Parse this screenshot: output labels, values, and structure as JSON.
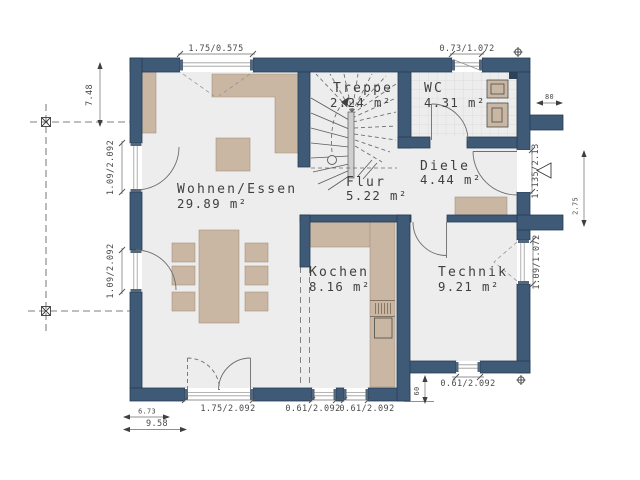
{
  "rooms": {
    "wohnen": {
      "name": "Wohnen/Essen",
      "area": "29.89 m²"
    },
    "treppe": {
      "name": "Treppe",
      "area": "2.24 m²"
    },
    "wc": {
      "name": "WC",
      "area": "4.31 m²"
    },
    "flur": {
      "name": "Flur",
      "area": "5.22 m²"
    },
    "diele": {
      "name": "Diele",
      "area": "4.44 m²"
    },
    "kochen": {
      "name": "Kochen",
      "area": "8.16 m²"
    },
    "technik": {
      "name": "Technik",
      "area": "9.21 m²"
    }
  },
  "dimensions": {
    "window_living_top": "1.75/0.575",
    "window_wc_top": "0.73/1.072",
    "stub_top_right": "80",
    "entry_door": "1.135/2.13",
    "right_vertical": "2.75",
    "window_technik_right": "1.09/1.072",
    "window_technik_bottom": "0.61/2.092",
    "offset_bottom_right": "60",
    "left_vertical": "7.48",
    "door_left_upper": "1.09/2.092",
    "door_left_lower": "1.09/2.092",
    "door_terrace": "1.75/2.092",
    "window_kochen_left": "0.61/2.092",
    "window_kochen_right": "0.61/2.092",
    "width_partial": "6.73",
    "width_total": "9.58"
  },
  "colors": {
    "wall": "#3f5a77",
    "wall_edge": "#253e57",
    "floor": "#ededed",
    "furniture": "#c9b7a3",
    "furniture_edge": "#a8947d",
    "tile_line": "#d7d7d7",
    "line": "#6e6e6e",
    "text": "#3f3f3f",
    "dim": "#4a4a4a"
  }
}
